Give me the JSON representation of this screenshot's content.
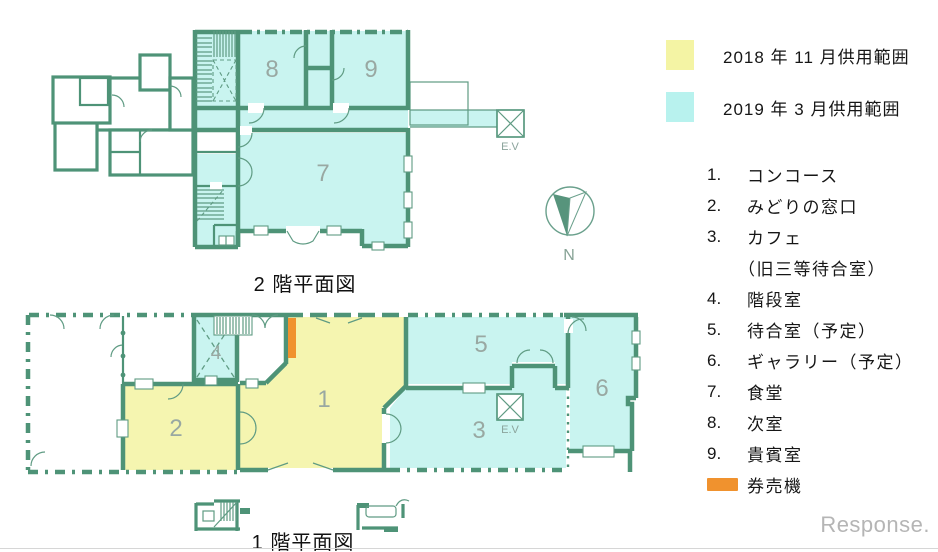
{
  "colors": {
    "wall_green": "#4e9377",
    "fill_cyan": "#c9f4f0",
    "fill_yellow": "#f5f5b0",
    "legend_yellow": "#f4f4a4",
    "legend_cyan": "#b8f2ee",
    "ticket_orange": "#f0922e"
  },
  "legend": {
    "items": [
      {
        "label": "2018 年 11 月供用範囲"
      },
      {
        "label": "2019 年 3 月供用範囲"
      }
    ]
  },
  "room_list": [
    {
      "num": "1.",
      "label": "コンコース"
    },
    {
      "num": "2.",
      "label": "みどりの窓口"
    },
    {
      "num": "3.",
      "label": "カフェ"
    },
    {
      "num": "",
      "label": "（旧三等待合室）"
    },
    {
      "num": "4.",
      "label": "階段室"
    },
    {
      "num": "5.",
      "label": "待合室（予定）"
    },
    {
      "num": "6.",
      "label": "ギャラリー（予定）"
    },
    {
      "num": "7.",
      "label": "食堂"
    },
    {
      "num": "8.",
      "label": "次室"
    },
    {
      "num": "9.",
      "label": "貴賓室"
    }
  ],
  "ticket_machine": {
    "label": "券売機"
  },
  "floor2": {
    "title": "2 階平面図",
    "rooms": {
      "r7": "7",
      "r8": "8",
      "r9": "9"
    },
    "elevator_label": "E.V"
  },
  "floor1": {
    "title": "1 階平面図",
    "rooms": {
      "r1": "1",
      "r2": "2",
      "r3": "3",
      "r4": "4",
      "r5": "5",
      "r6": "6"
    },
    "elevator_label": "E.V"
  },
  "compass": {
    "label": "N"
  },
  "watermark": {
    "text": "Response."
  }
}
